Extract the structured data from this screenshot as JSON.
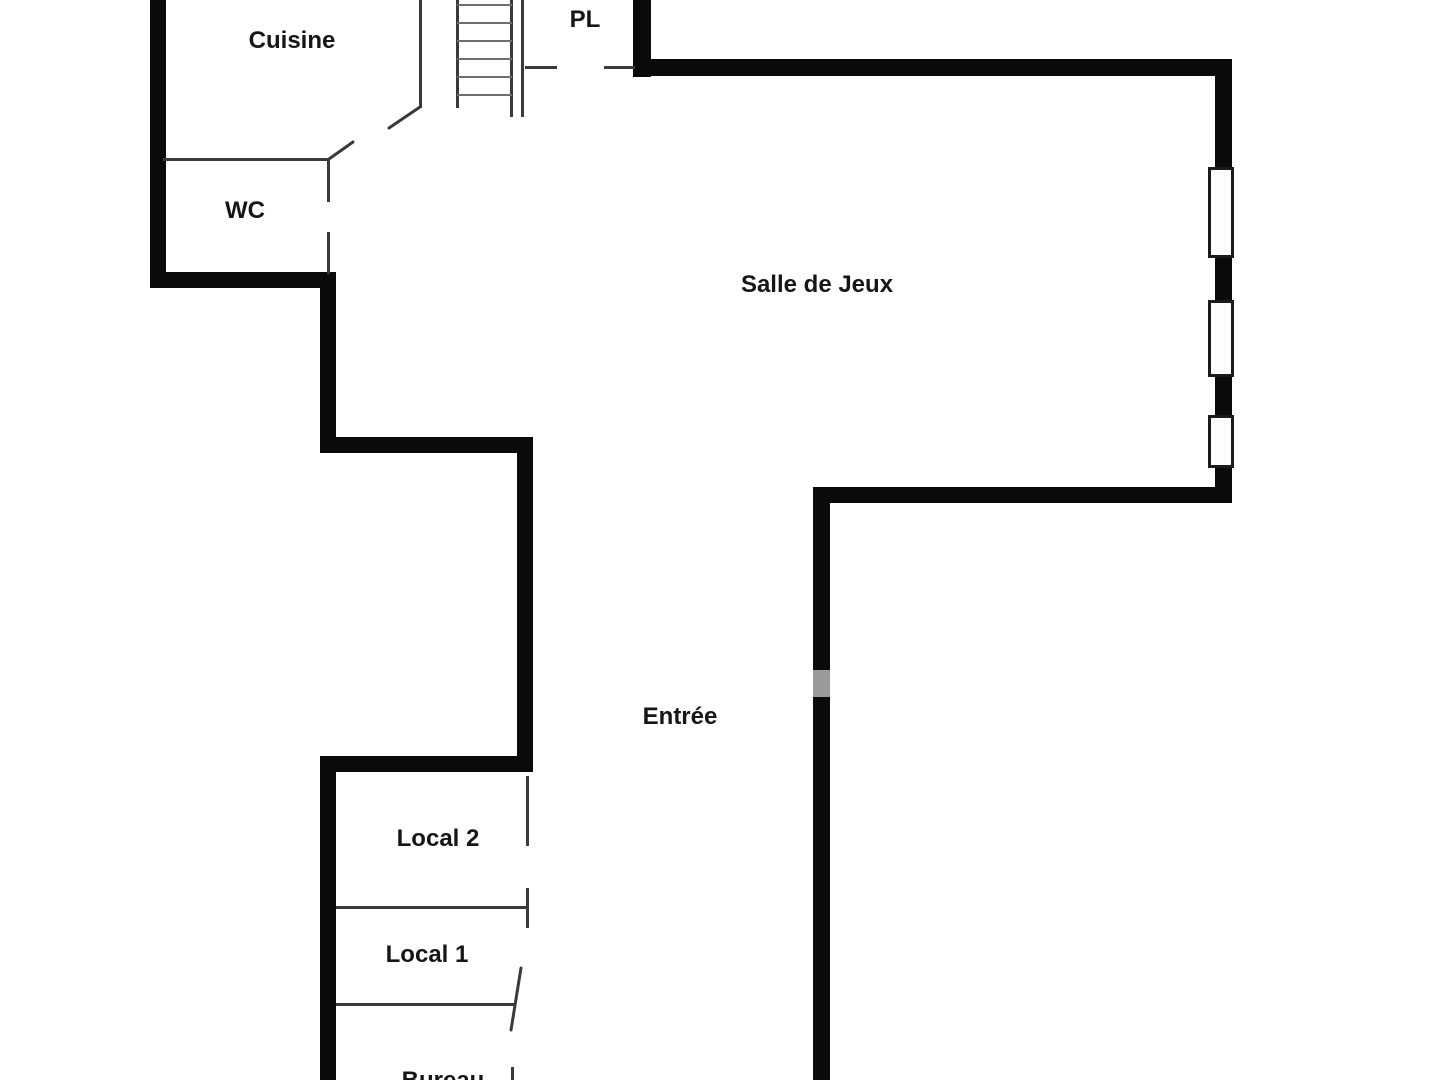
{
  "colors": {
    "background": "#ffffff",
    "wall": "#0a0a0a",
    "thin_line": "#3a3a3a",
    "stair_rung": "#6e6e6e",
    "label_text": "#161616",
    "window_border": "#1b1b1b",
    "window_fill": "#fdfdfd",
    "wall_smudge": "#9a9a9a"
  },
  "rooms": [
    {
      "id": "cuisine",
      "label": "Cuisine",
      "cx": 292,
      "cy": 41
    },
    {
      "id": "pl",
      "label": "PL",
      "cx": 585,
      "cy": 20
    },
    {
      "id": "wc",
      "label": "WC",
      "cx": 245,
      "cy": 211
    },
    {
      "id": "salle-de-jeux",
      "label": "Salle de Jeux",
      "cx": 817,
      "cy": 285
    },
    {
      "id": "entree",
      "label": "Entrée",
      "cx": 680,
      "cy": 717
    },
    {
      "id": "local-2",
      "label": "Local 2",
      "cx": 438,
      "cy": 839
    },
    {
      "id": "local-1",
      "label": "Local 1",
      "cx": 427,
      "cy": 955
    },
    {
      "id": "bureau",
      "label": "Bureau",
      "cx": 443,
      "cy": 1081
    }
  ],
  "thick_walls": [
    {
      "name": "left-wall-cuisine-wc",
      "x": 150,
      "y": 0,
      "w": 16,
      "h": 288
    },
    {
      "name": "wc-bottom-wall",
      "x": 150,
      "y": 272,
      "w": 185,
      "h": 16
    },
    {
      "name": "mid-left-vertical-wall",
      "x": 320,
      "y": 272,
      "w": 16,
      "h": 181
    },
    {
      "name": "mid-horizontal-wall",
      "x": 320,
      "y": 437,
      "w": 213,
      "h": 16
    },
    {
      "name": "corridor-left-vertical-wall",
      "x": 517,
      "y": 437,
      "w": 16,
      "h": 335
    },
    {
      "name": "locaux-top-wall",
      "x": 320,
      "y": 756,
      "w": 213,
      "h": 16
    },
    {
      "name": "locaux-left-vertical-wall",
      "x": 320,
      "y": 756,
      "w": 16,
      "h": 324
    },
    {
      "name": "pl-right-wall",
      "x": 633,
      "y": 0,
      "w": 18,
      "h": 77
    },
    {
      "name": "salle-de-jeux-top-wall",
      "x": 633,
      "y": 59,
      "w": 599,
      "h": 17
    },
    {
      "name": "salle-de-jeux-right-wall",
      "x": 1215,
      "y": 59,
      "w": 17,
      "h": 444
    },
    {
      "name": "salle-de-jeux-bottom-wall",
      "x": 813,
      "y": 487,
      "w": 419,
      "h": 16
    },
    {
      "name": "corridor-right-vertical-wall",
      "x": 813,
      "y": 487,
      "w": 17,
      "h": 593
    }
  ],
  "thin_walls": [
    {
      "name": "cuisine-right-wall",
      "x": 419,
      "y": 0,
      "w": 3,
      "h": 108
    },
    {
      "name": "wc-top-wall",
      "x": 163,
      "y": 158,
      "w": 167,
      "h": 3
    },
    {
      "name": "wc-right-wall-upper",
      "x": 327,
      "y": 158,
      "w": 3,
      "h": 44
    },
    {
      "name": "wc-right-wall-lower",
      "x": 327,
      "y": 232,
      "w": 3,
      "h": 42
    },
    {
      "name": "stair-left-stringer",
      "x": 456,
      "y": 0,
      "w": 3,
      "h": 108
    },
    {
      "name": "stair-right-stringer",
      "x": 510,
      "y": 0,
      "w": 3,
      "h": 117
    },
    {
      "name": "stair-outer-line",
      "x": 521,
      "y": 0,
      "w": 3,
      "h": 117
    },
    {
      "name": "pl-bottom-wall-left",
      "x": 525,
      "y": 66,
      "w": 32,
      "h": 3
    },
    {
      "name": "pl-bottom-wall-right",
      "x": 604,
      "y": 66,
      "w": 31,
      "h": 3
    },
    {
      "name": "local2-right-wall",
      "x": 526,
      "y": 776,
      "w": 3,
      "h": 70
    },
    {
      "name": "local2-local1-divider",
      "x": 336,
      "y": 906,
      "w": 192,
      "h": 3
    },
    {
      "name": "local1-door-jamb",
      "x": 526,
      "y": 888,
      "w": 3,
      "h": 40
    },
    {
      "name": "local1-bureau-divider",
      "x": 336,
      "y": 1003,
      "w": 178,
      "h": 3
    },
    {
      "name": "bureau-door-jamb",
      "x": 511,
      "y": 1067,
      "w": 3,
      "h": 13
    }
  ],
  "diagonal_lines": [
    {
      "name": "cuisine-door-upper-jamb",
      "x1": 420,
      "y1": 107,
      "x2": 389,
      "y2": 128
    },
    {
      "name": "cuisine-door-lower-jamb",
      "x1": 353,
      "y1": 142,
      "x2": 329,
      "y2": 159
    },
    {
      "name": "local1-door-leaf",
      "x1": 521,
      "y1": 968,
      "x2": 511,
      "y2": 1030
    }
  ],
  "stairs": {
    "x1": 457,
    "x2": 512,
    "rung_thickness": 2,
    "rung_ys": [
      4,
      22,
      40,
      58,
      76,
      94
    ]
  },
  "windows": [
    {
      "name": "window-1",
      "x": 1208,
      "y": 167,
      "w": 26,
      "h": 91
    },
    {
      "name": "window-2",
      "x": 1208,
      "y": 300,
      "w": 26,
      "h": 77
    },
    {
      "name": "window-3",
      "x": 1208,
      "y": 415,
      "w": 26,
      "h": 53
    }
  ],
  "wall_smudge": {
    "x": 813,
    "y": 670,
    "w": 17,
    "h": 27
  }
}
